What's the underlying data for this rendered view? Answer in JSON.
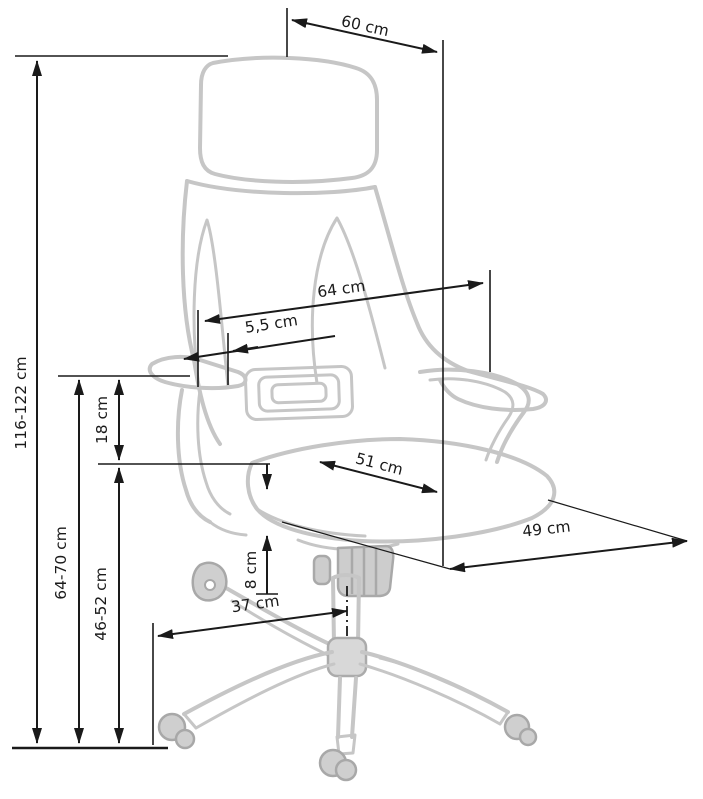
{
  "diagram": {
    "subject": "office-chair-dimension-diagram",
    "background": "#ffffff",
    "dimension_color": "#1a1a1a",
    "artwork_color": "#c6c6c6",
    "labels": {
      "headrest_width": "60 cm",
      "overall_height": "116-122 cm",
      "backrest_width": "64 cm",
      "armrest_offset": "5,5 cm",
      "armrest_pad_height": "18 cm",
      "seat_width": "51 cm",
      "seat_depth": "49 cm",
      "height_to_armrest": "64-70 cm",
      "seat_height": "46-52 cm",
      "cushion_thickness": "8 cm",
      "base_leg_span": "37 cm"
    }
  }
}
